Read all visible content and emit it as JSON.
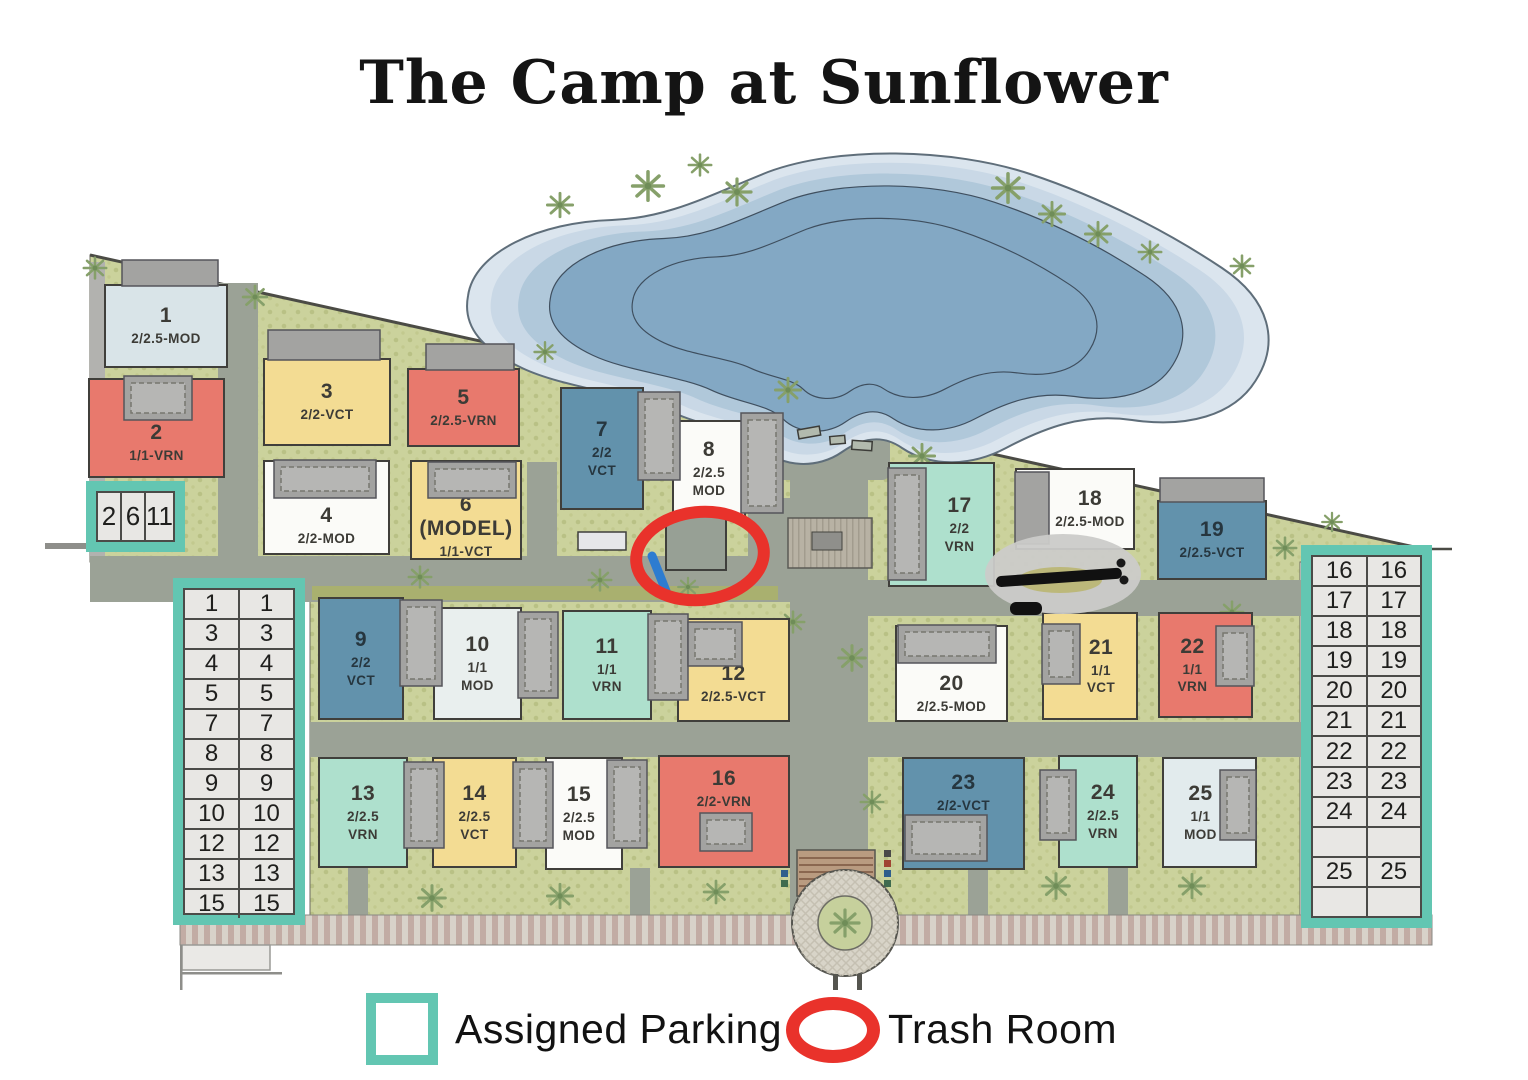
{
  "title": "The Camp at Sunflower",
  "palette": {
    "red": "#E8796D",
    "yellow": "#F3DC93",
    "blue": "#6292AC",
    "mint": "#AEE0CD",
    "white": "#FBFBF8",
    "pale": "#E9EFEE",
    "lightblue": "#D9E4E8",
    "paleblue": "#E2EBED",
    "teal_accent": "#63C6B2",
    "trash_red": "#E9322B",
    "site_green": "#CBD29C",
    "road_gray": "#9BA296",
    "pond_blue": "#83A8C4"
  },
  "buildings": [
    {
      "num": "1",
      "type": "2/2.5-MOD",
      "color": "lightblue"
    },
    {
      "num": "2",
      "type": "1/1-VRN",
      "color": "red"
    },
    {
      "num": "3",
      "type": "2/2-VCT",
      "color": "yellow"
    },
    {
      "num": "4",
      "type": "2/2-MOD",
      "color": "white"
    },
    {
      "num": "5",
      "type": "2/2.5-VRN",
      "color": "red"
    },
    {
      "num": "6 (MODEL)",
      "type": "1/1-VCT",
      "color": "yellow"
    },
    {
      "num": "7",
      "type": "2/2\nVCT",
      "color": "blue"
    },
    {
      "num": "8",
      "type": "2/2.5\nMOD",
      "color": "white"
    },
    {
      "num": "9",
      "type": "2/2\nVCT",
      "color": "blue"
    },
    {
      "num": "10",
      "type": "1/1\nMOD",
      "color": "pale"
    },
    {
      "num": "11",
      "type": "1/1\nVRN",
      "color": "mint"
    },
    {
      "num": "12",
      "type": "2/2.5-VCT",
      "color": "yellow"
    },
    {
      "num": "13",
      "type": "2/2.5\nVRN",
      "color": "mint"
    },
    {
      "num": "14",
      "type": "2/2.5\nVCT",
      "color": "yellow"
    },
    {
      "num": "15",
      "type": "2/2.5\nMOD",
      "color": "white"
    },
    {
      "num": "16",
      "type": "2/2-VRN",
      "color": "red"
    },
    {
      "num": "17",
      "type": "2/2\nVRN",
      "color": "mint"
    },
    {
      "num": "18",
      "type": "2/2.5-MOD",
      "color": "white"
    },
    {
      "num": "19",
      "type": "2/2.5-VCT",
      "color": "blue"
    },
    {
      "num": "20",
      "type": "2/2.5-MOD",
      "color": "white"
    },
    {
      "num": "21",
      "type": "1/1\nVCT",
      "color": "yellow"
    },
    {
      "num": "22",
      "type": "1/1\nVRN",
      "color": "red"
    },
    {
      "num": "23",
      "type": "2/2-VCT",
      "color": "blue"
    },
    {
      "num": "24",
      "type": "2/2.5\nVRN",
      "color": "mint"
    },
    {
      "num": "25",
      "type": "1/1\nMOD",
      "color": "paleblue"
    }
  ],
  "parking_box": [
    "2",
    "6",
    "11"
  ],
  "parking_left": [
    "1",
    "3",
    "4",
    "5",
    "7",
    "8",
    "9",
    "10",
    "12",
    "13",
    "15"
  ],
  "parking_right": [
    "16",
    "17",
    "18",
    "19",
    "20",
    "21",
    "22",
    "23",
    "24",
    "",
    "25",
    ""
  ],
  "legend": {
    "parking": "Assigned Parking",
    "trash": "Trash Room"
  }
}
